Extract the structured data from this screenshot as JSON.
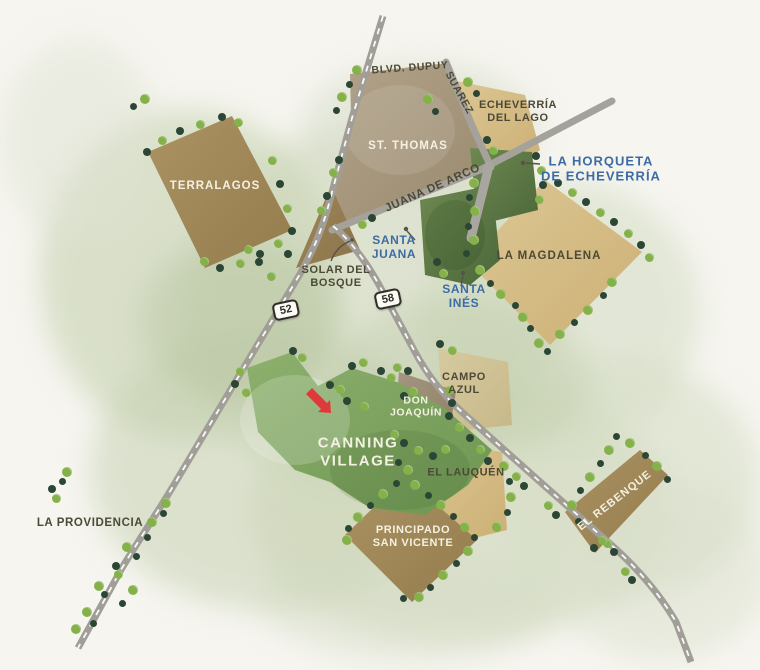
{
  "map": {
    "title": "Canning area neighborhoods map",
    "labels": {
      "blvd_dupuy": {
        "text": "BLVD. DUPUY"
      },
      "suarez": {
        "text": "SUAREZ"
      },
      "st_thomas": {
        "text": "ST. THOMAS"
      },
      "terralagos": {
        "text": "TERRALAGOS"
      },
      "echeverria_del_lago": {
        "line1": "ECHEVERRÍA",
        "line2": "DEL LAGO"
      },
      "la_horqueta": {
        "line1": "LA HORQUETA",
        "line2": "DE ECHEVERRÍA"
      },
      "juana_de_arco": {
        "text": "JUANA DE ARCO"
      },
      "santa_juana": {
        "line1": "SANTA",
        "line2": "JUANA"
      },
      "santa_ines": {
        "line1": "SANTA",
        "line2": "INÉS"
      },
      "la_magdalena": {
        "text": "LA MAGDALENA"
      },
      "solar_del_bosque": {
        "line1": "SOLAR DEL",
        "line2": "BOSQUE"
      },
      "campo_azul": {
        "line1": "CAMPO",
        "line2": "AZUL"
      },
      "don_joaquin": {
        "line1": "DON",
        "line2": "JOAQUÍN"
      },
      "canning_village": {
        "line1": "CANNING",
        "line2": "VILLAGE"
      },
      "el_lauquen": {
        "text": "EL LAUQUÉN"
      },
      "principado_san_vicente": {
        "line1": "PRINCIPADO",
        "line2": "SAN VICENTE"
      },
      "el_rebenque": {
        "text": "EL REBENQUE"
      },
      "la_providencia": {
        "text": "LA PROVIDENCIA"
      }
    },
    "shields": {
      "route52": "52",
      "route58": "58"
    },
    "colors": {
      "label_dark": "#4c4936",
      "label_blue": "#3d6ca5",
      "label_light": "#f4f1e2",
      "highlight_arrow": "#e0393c",
      "tree_light": "#85b14b",
      "tree_dark": "#2b4634",
      "road_gray": "#a5a29b",
      "parcel_green": "#7da25f",
      "parcel_dark_green": "#5c7645",
      "parcel_tan": "#d5bf8b",
      "parcel_brown": "#a0885c",
      "parcel_taupe": "#a89879",
      "background": "#f6f5f0"
    },
    "trees": [
      [
        162,
        140,
        "l"
      ],
      [
        180,
        131,
        "d"
      ],
      [
        200,
        124,
        "l"
      ],
      [
        222,
        117,
        "d"
      ],
      [
        238,
        122,
        "l"
      ],
      [
        147,
        152,
        "d"
      ],
      [
        133,
        106,
        "d"
      ],
      [
        145,
        99,
        "l"
      ],
      [
        272,
        160,
        "l"
      ],
      [
        280,
        184,
        "d"
      ],
      [
        287,
        208,
        "l"
      ],
      [
        292,
        231,
        "d"
      ],
      [
        278,
        243,
        "l"
      ],
      [
        260,
        254,
        "d"
      ],
      [
        240,
        263,
        "l"
      ],
      [
        220,
        268,
        "d"
      ],
      [
        204,
        261,
        "l"
      ],
      [
        357,
        70,
        "l"
      ],
      [
        349,
        84,
        "d"
      ],
      [
        342,
        97,
        "l"
      ],
      [
        336,
        110,
        "d"
      ],
      [
        339,
        160,
        "d"
      ],
      [
        333,
        172,
        "l"
      ],
      [
        327,
        196,
        "d"
      ],
      [
        321,
        210,
        "l"
      ],
      [
        428,
        99,
        "l"
      ],
      [
        435,
        111,
        "d"
      ],
      [
        468,
        82,
        "l"
      ],
      [
        476,
        93,
        "d"
      ],
      [
        487,
        140,
        "d"
      ],
      [
        493,
        150,
        "l"
      ],
      [
        372,
        218,
        "d"
      ],
      [
        362,
        224,
        "l"
      ],
      [
        536,
        156,
        "d"
      ],
      [
        541,
        170,
        "l"
      ],
      [
        543,
        185,
        "d"
      ],
      [
        539,
        199,
        "l"
      ],
      [
        474,
        183,
        "l"
      ],
      [
        469,
        197,
        "d"
      ],
      [
        475,
        211,
        "l"
      ],
      [
        468,
        226,
        "d"
      ],
      [
        474,
        240,
        "l"
      ],
      [
        466,
        253,
        "d"
      ],
      [
        437,
        262,
        "d"
      ],
      [
        443,
        273,
        "l"
      ],
      [
        558,
        183,
        "d"
      ],
      [
        572,
        192,
        "l"
      ],
      [
        586,
        202,
        "d"
      ],
      [
        600,
        212,
        "l"
      ],
      [
        614,
        222,
        "d"
      ],
      [
        628,
        233,
        "l"
      ],
      [
        641,
        245,
        "d"
      ],
      [
        649,
        257,
        "l"
      ],
      [
        612,
        282,
        "l"
      ],
      [
        603,
        295,
        "d"
      ],
      [
        588,
        310,
        "l"
      ],
      [
        574,
        322,
        "d"
      ],
      [
        560,
        334,
        "l"
      ],
      [
        547,
        351,
        "d"
      ],
      [
        539,
        343,
        "l"
      ],
      [
        530,
        328,
        "d"
      ],
      [
        523,
        317,
        "l"
      ],
      [
        515,
        305,
        "d"
      ],
      [
        501,
        294,
        "l"
      ],
      [
        490,
        283,
        "d"
      ],
      [
        480,
        270,
        "l"
      ],
      [
        248,
        249,
        "l"
      ],
      [
        259,
        262,
        "d"
      ],
      [
        271,
        276,
        "l"
      ],
      [
        288,
        254,
        "d"
      ],
      [
        240,
        371,
        "l"
      ],
      [
        235,
        384,
        "d"
      ],
      [
        246,
        392,
        "l"
      ],
      [
        293,
        351,
        "d"
      ],
      [
        302,
        357,
        "l"
      ],
      [
        330,
        385,
        "d"
      ],
      [
        340,
        389,
        "l"
      ],
      [
        352,
        366,
        "d"
      ],
      [
        363,
        362,
        "l"
      ],
      [
        381,
        371,
        "d"
      ],
      [
        391,
        377,
        "l"
      ],
      [
        347,
        401,
        "d"
      ],
      [
        364,
        406,
        "l"
      ],
      [
        404,
        396,
        "d"
      ],
      [
        413,
        391,
        "l"
      ],
      [
        449,
        416,
        "d"
      ],
      [
        459,
        427,
        "l"
      ],
      [
        470,
        438,
        "d"
      ],
      [
        480,
        449,
        "l"
      ],
      [
        488,
        461,
        "d"
      ],
      [
        398,
        462,
        "d"
      ],
      [
        408,
        470,
        "l"
      ],
      [
        397,
        367,
        "l"
      ],
      [
        408,
        371,
        "d"
      ],
      [
        449,
        390,
        "l"
      ],
      [
        452,
        403,
        "d"
      ],
      [
        394,
        434,
        "l"
      ],
      [
        404,
        443,
        "d"
      ],
      [
        418,
        450,
        "l"
      ],
      [
        433,
        456,
        "d"
      ],
      [
        445,
        449,
        "l"
      ],
      [
        440,
        344,
        "d"
      ],
      [
        452,
        350,
        "l"
      ],
      [
        504,
        466,
        "l"
      ],
      [
        509,
        481,
        "d"
      ],
      [
        511,
        497,
        "l"
      ],
      [
        507,
        512,
        "d"
      ],
      [
        497,
        527,
        "l"
      ],
      [
        396,
        483,
        "d"
      ],
      [
        383,
        494,
        "l"
      ],
      [
        370,
        505,
        "d"
      ],
      [
        358,
        517,
        "l"
      ],
      [
        348,
        528,
        "d"
      ],
      [
        415,
        485,
        "l"
      ],
      [
        428,
        495,
        "d"
      ],
      [
        441,
        505,
        "l"
      ],
      [
        453,
        516,
        "d"
      ],
      [
        465,
        527,
        "l"
      ],
      [
        474,
        537,
        "d"
      ],
      [
        468,
        551,
        "l"
      ],
      [
        456,
        563,
        "d"
      ],
      [
        443,
        575,
        "l"
      ],
      [
        430,
        587,
        "d"
      ],
      [
        419,
        597,
        "l"
      ],
      [
        403,
        598,
        "d"
      ],
      [
        347,
        540,
        "l"
      ],
      [
        516,
        476,
        "l"
      ],
      [
        524,
        486,
        "d"
      ],
      [
        548,
        505,
        "l"
      ],
      [
        556,
        515,
        "d"
      ],
      [
        607,
        543,
        "l"
      ],
      [
        614,
        552,
        "d"
      ],
      [
        625,
        571,
        "l"
      ],
      [
        632,
        580,
        "d"
      ],
      [
        616,
        436,
        "d"
      ],
      [
        630,
        443,
        "l"
      ],
      [
        645,
        455,
        "d"
      ],
      [
        657,
        466,
        "l"
      ],
      [
        667,
        479,
        "d"
      ],
      [
        572,
        505,
        "l"
      ],
      [
        580,
        490,
        "d"
      ],
      [
        590,
        477,
        "l"
      ],
      [
        600,
        463,
        "d"
      ],
      [
        609,
        450,
        "l"
      ],
      [
        578,
        521,
        "d"
      ],
      [
        594,
        548,
        "d"
      ],
      [
        602,
        540,
        "l"
      ],
      [
        67,
        472,
        "l"
      ],
      [
        62,
        481,
        "d"
      ],
      [
        52,
        489,
        "d"
      ],
      [
        56,
        498,
        "l"
      ],
      [
        166,
        503,
        "l"
      ],
      [
        163,
        513,
        "d"
      ],
      [
        152,
        522,
        "l"
      ],
      [
        147,
        537,
        "d"
      ],
      [
        127,
        547,
        "l"
      ],
      [
        136,
        556,
        "d"
      ],
      [
        116,
        566,
        "d"
      ],
      [
        118,
        574,
        "l"
      ],
      [
        133,
        590,
        "l"
      ],
      [
        122,
        603,
        "d"
      ],
      [
        99,
        586,
        "l"
      ],
      [
        104,
        594,
        "d"
      ],
      [
        87,
        612,
        "l"
      ],
      [
        93,
        623,
        "d"
      ],
      [
        76,
        629,
        "l"
      ]
    ]
  }
}
